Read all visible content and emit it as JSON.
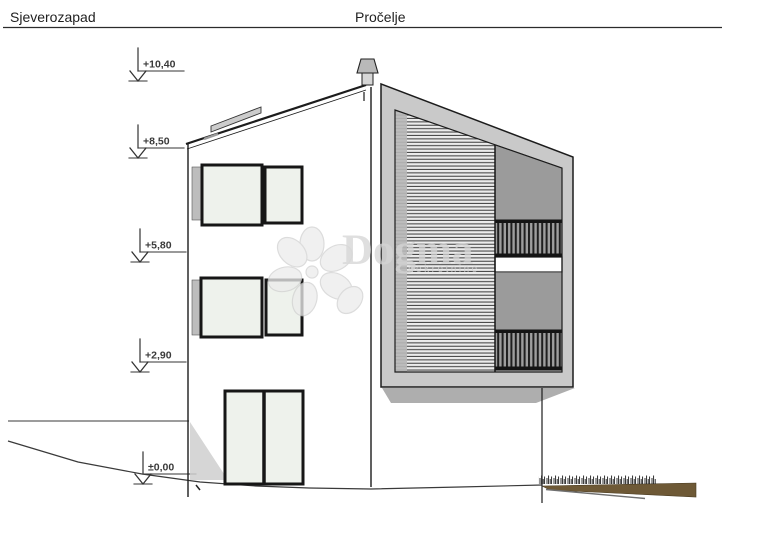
{
  "title_block": {
    "left": "Sjeverozapad",
    "right": "Pročelje"
  },
  "elevation_markers": [
    {
      "label": "+10,40"
    },
    {
      "label": "+8,50"
    },
    {
      "label": "+5,80"
    },
    {
      "label": "+2,90"
    },
    {
      "label": "±0,00"
    }
  ],
  "watermark": {
    "brand": "Dogma",
    "subtext": "nekretnine"
  },
  "colors": {
    "frame_gray": "#c9c9c9",
    "panel_gray": "#9b9b9b",
    "glass": "#eef2ec",
    "shutter_gray": "#bdbdbd",
    "shadow_gray": "#aeaeae",
    "earth_brown": "#6e5936",
    "line_dark": "#1c1c1c"
  }
}
